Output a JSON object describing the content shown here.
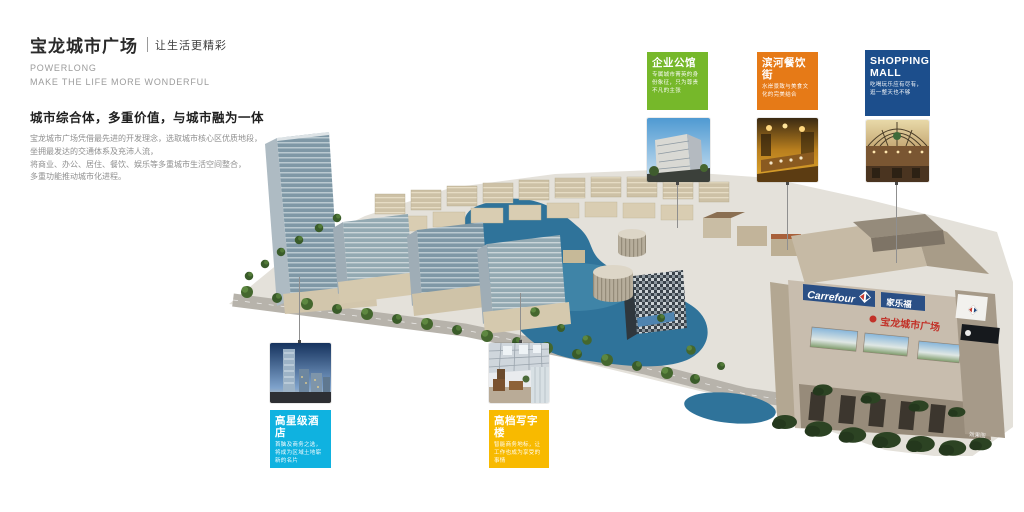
{
  "header": {
    "title": "宝龙城市广场",
    "tagline": "让生活更精彩",
    "en_line1": "POWERLONG",
    "en_line2": "MAKE THE LIFE MORE WONDERFUL",
    "heading": "城市综合体，多重价值，与城市融为一体",
    "body_lines": [
      "宝龙城市广场凭借最先进的开发理念，选取城市核心区优质地段，",
      "坐拥最发达的交通体系及充沛人流，",
      "将商业、办公、居住、餐饮、娱乐等多重城市生活空间整合，",
      "多重功能推动城市化进程。"
    ]
  },
  "callouts": [
    {
      "id": "enterprise-mansion",
      "title": "企业公馆",
      "desc": "专属城市菁英的身份象征，只为尊贵不凡的主张",
      "color": "#76b82a"
    },
    {
      "id": "riverside-dining-street",
      "title": "滨河餐饮街",
      "desc": "水岸景致与美食文化的完美结合",
      "color": "#e67a17"
    },
    {
      "id": "shopping-mall",
      "title": "SHOPPING MALL",
      "desc": "吃喝玩乐应有尽有，逛一整天也不够",
      "color": "#1c4e8c"
    },
    {
      "id": "star-hotel",
      "title": "高星级酒店",
      "desc": "首脑及商务之选，将成为区域土地崭新的名片",
      "color": "#0fb2e0"
    },
    {
      "id": "office-tower",
      "title": "高档写字楼",
      "desc": "智能商务地标，让工作也成为享受的事情",
      "color": "#f8ba00"
    }
  ],
  "rendering": {
    "carrefour_en": "Carrefour",
    "carrefour_cn": "家乐福",
    "plaza_sign": "宝龙城市广场",
    "watermark": "效果图"
  }
}
